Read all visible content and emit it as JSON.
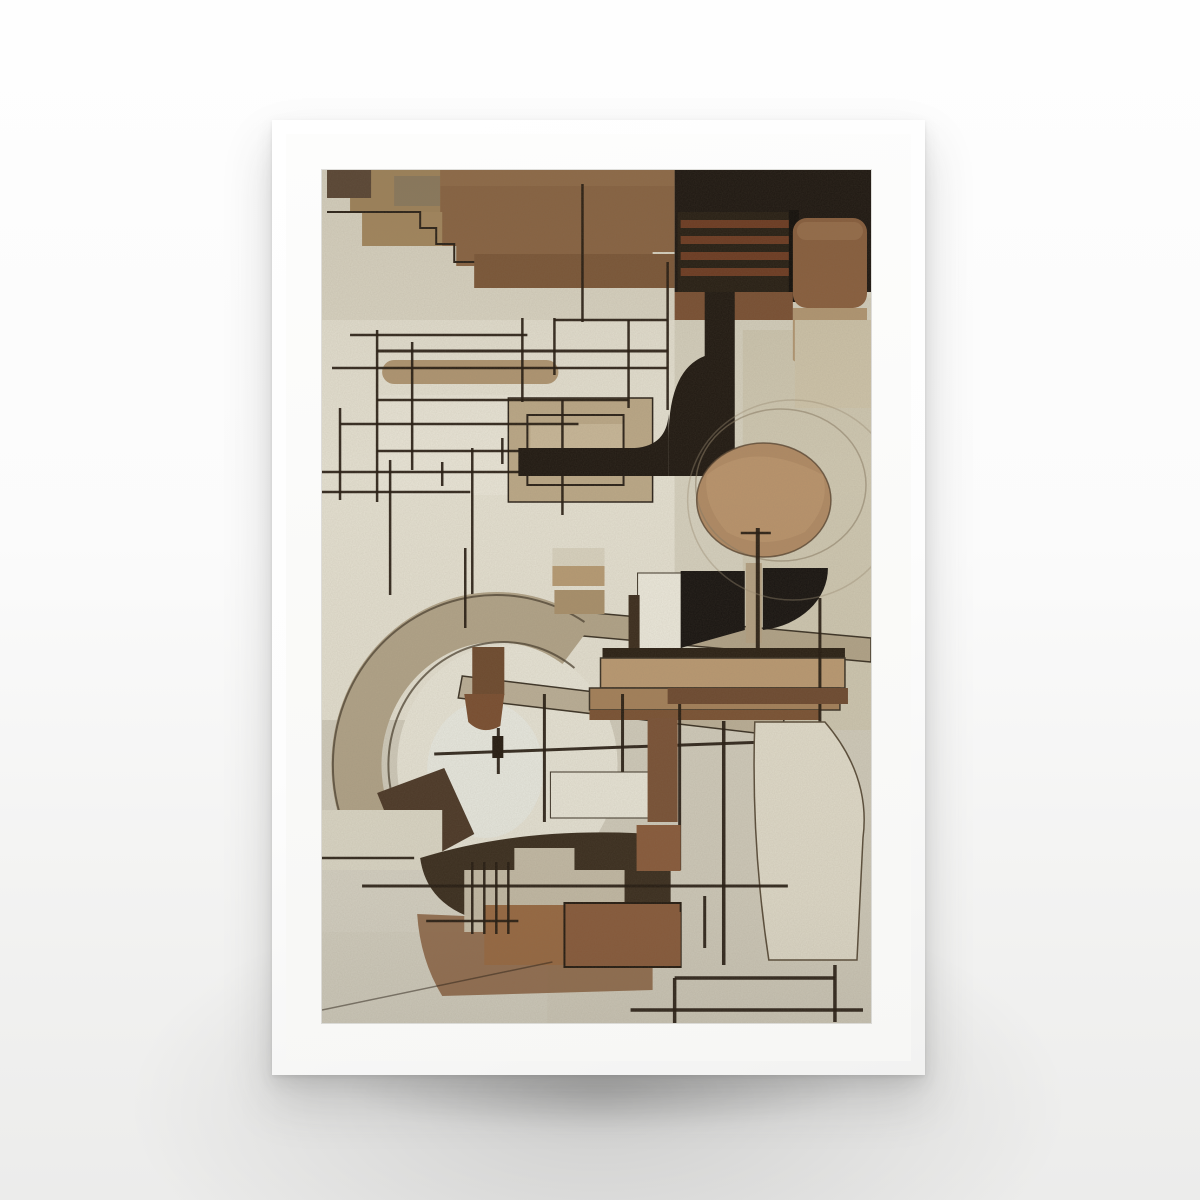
{
  "meta": {
    "description": "Product photo of a framed poster: abstract geometric constructivist composition in shades of brown, beige and black on textured paper, in a white frame with white mat, on a light studio background with soft shadow.",
    "artwork_alt": "Abstract cubist composition with brown rectangles, black fields, thin ruled black lines, arcs, a tan circle and curved black shapes on beige paper"
  },
  "palette": {
    "page_bg": "#fbfbfb",
    "frame": "#fdfdfd",
    "mat": "#fcfcfb",
    "paper": "#dbd6c5",
    "line_color": "#241a10",
    "brown_dark": "#5a4635",
    "brown_mid": "#8a6443",
    "tan": "#b09672",
    "black_field": "#1b1510"
  },
  "artwork": {
    "viewbox": "0 0 548 853",
    "shapes": [
      {
        "t": "rect",
        "x": 0,
        "y": 0,
        "w": 548,
        "h": 853,
        "f": "#dbd6c5"
      },
      {
        "t": "rect",
        "x": 0,
        "y": 150,
        "w": 352,
        "h": 400,
        "f": "#e5e1d2"
      },
      {
        "t": "rect",
        "x": 0,
        "y": 550,
        "w": 548,
        "h": 303,
        "f": "#d2cdbd"
      },
      {
        "t": "rect",
        "x": 352,
        "y": 128,
        "w": 196,
        "h": 430,
        "f": "#d6d1bf"
      },
      {
        "t": "rect",
        "x": 420,
        "y": 160,
        "w": 128,
        "h": 400,
        "f": "#cfc8b2"
      },
      {
        "t": "rect",
        "x": 28,
        "y": 0,
        "w": 92,
        "h": 42,
        "f": "#a1855c"
      },
      {
        "t": "rect",
        "x": 5,
        "y": 0,
        "w": 44,
        "h": 28,
        "f": "#5a4635"
      },
      {
        "t": "rect",
        "x": 72,
        "y": 6,
        "w": 46,
        "h": 30,
        "f": "#8d7b5f"
      },
      {
        "t": "poly",
        "pts": "118,0 352,0 352,82 330,82 330,118 152,118 152,96 134,96 134,76 118,76",
        "f": "#8a6443"
      },
      {
        "t": "rect",
        "x": 40,
        "y": 42,
        "w": 80,
        "h": 34,
        "f": "#a5885f"
      },
      {
        "t": "rect",
        "x": 152,
        "y": 84,
        "w": 200,
        "h": 34,
        "f": "#7c5738"
      },
      {
        "t": "rect",
        "x": 118,
        "y": 0,
        "w": 234,
        "h": 16,
        "f": "#97724e",
        "o": 0.55
      },
      {
        "t": "path",
        "d": "M5,42 L98,42 L98,58 L114,58 L114,74 L132,74 L132,92 L152,92",
        "s": "#2a2118",
        "sw": 2,
        "f": "none"
      },
      {
        "t": "line",
        "x1": 260,
        "y1": 14,
        "x2": 260,
        "y2": 152
      },
      {
        "t": "line",
        "x1": 345,
        "y1": 92,
        "x2": 345,
        "y2": 240
      },
      {
        "t": "rect",
        "x": 352,
        "y": 0,
        "w": 196,
        "h": 122,
        "f": "#1b1510"
      },
      {
        "t": "rect",
        "x": 355,
        "y": 42,
        "w": 118,
        "h": 88,
        "f": "#251d13"
      },
      {
        "t": "rect",
        "x": 358,
        "y": 50,
        "w": 110,
        "h": 8,
        "f": "#6e3b22"
      },
      {
        "t": "rect",
        "x": 358,
        "y": 66,
        "w": 110,
        "h": 8,
        "f": "#6e3b22"
      },
      {
        "t": "rect",
        "x": 358,
        "y": 82,
        "w": 110,
        "h": 8,
        "f": "#6e3b22"
      },
      {
        "t": "rect",
        "x": 358,
        "y": 98,
        "w": 110,
        "h": 8,
        "f": "#6e3b22"
      },
      {
        "t": "rect",
        "x": 466,
        "y": 40,
        "w": 10,
        "h": 92,
        "f": "#0f0c09"
      },
      {
        "t": "rect",
        "x": 470,
        "y": 48,
        "w": 74,
        "h": 90,
        "rx": 14,
        "f": "#8a5f3e"
      },
      {
        "t": "rect",
        "x": 474,
        "y": 52,
        "w": 66,
        "h": 18,
        "rx": 9,
        "f": "#9d7350",
        "o": 0.7
      },
      {
        "t": "path",
        "d": "M470,138 L544,138 L544,196 Q520,212 492,206 L470,190 Z",
        "f": "#b39873"
      },
      {
        "t": "rect",
        "x": 352,
        "y": 122,
        "w": 118,
        "h": 28,
        "f": "#7a5033"
      },
      {
        "t": "rect",
        "x": 472,
        "y": 150,
        "w": 76,
        "h": 88,
        "f": "#cfc5ab"
      },
      {
        "t": "rect",
        "x": 55,
        "y": 225,
        "w": 180,
        "h": 100,
        "f": "#e9e5d7"
      },
      {
        "t": "rect",
        "x": 186,
        "y": 228,
        "w": 144,
        "h": 104,
        "f": "#bba887",
        "s": "#2a2118",
        "sw": 1.5
      },
      {
        "t": "rect",
        "x": 208,
        "y": 254,
        "w": 92,
        "h": 46,
        "f": "#cdbd9f",
        "o": 0.7
      },
      {
        "t": "rect",
        "x": 60,
        "y": 190,
        "w": 176,
        "h": 24,
        "rx": 12,
        "f": "#b09672"
      },
      {
        "t": "line",
        "x1": 28,
        "y1": 165,
        "x2": 205,
        "y2": 165
      },
      {
        "t": "line",
        "x1": 55,
        "y1": 181,
        "x2": 345,
        "y2": 181,
        "sw": 3
      },
      {
        "t": "line",
        "x1": 10,
        "y1": 198,
        "x2": 345,
        "y2": 198
      },
      {
        "t": "line",
        "x1": 55,
        "y1": 230,
        "x2": 306,
        "y2": 230
      },
      {
        "t": "line",
        "x1": 18,
        "y1": 254,
        "x2": 256,
        "y2": 254
      },
      {
        "t": "line",
        "x1": 55,
        "y1": 281,
        "x2": 236,
        "y2": 281
      },
      {
        "t": "line",
        "x1": 0,
        "y1": 302,
        "x2": 205,
        "y2": 302
      },
      {
        "t": "line",
        "x1": 0,
        "y1": 322,
        "x2": 148,
        "y2": 322
      },
      {
        "t": "line",
        "x1": 55,
        "y1": 160,
        "x2": 55,
        "y2": 332
      },
      {
        "t": "line",
        "x1": 90,
        "y1": 172,
        "x2": 90,
        "y2": 300
      },
      {
        "t": "line",
        "x1": 200,
        "y1": 148,
        "x2": 200,
        "y2": 232
      },
      {
        "t": "line",
        "x1": 18,
        "y1": 238,
        "x2": 18,
        "y2": 330
      },
      {
        "t": "line",
        "x1": 68,
        "y1": 290,
        "x2": 68,
        "y2": 425
      },
      {
        "t": "line",
        "x1": 150,
        "y1": 278,
        "x2": 150,
        "y2": 430
      },
      {
        "t": "line",
        "x1": 232,
        "y1": 148,
        "x2": 232,
        "y2": 205
      },
      {
        "t": "line",
        "x1": 306,
        "y1": 150,
        "x2": 306,
        "y2": 238
      },
      {
        "t": "line",
        "x1": 232,
        "y1": 150,
        "x2": 345,
        "y2": 150
      },
      {
        "t": "rect",
        "x": 205,
        "y": 245,
        "w": 96,
        "h": 70,
        "f": "none",
        "s": "#2a2118",
        "sw": 2
      },
      {
        "t": "line",
        "x1": 240,
        "y1": 230,
        "x2": 240,
        "y2": 345
      },
      {
        "t": "line",
        "x1": 120,
        "y1": 292,
        "x2": 120,
        "y2": 316
      },
      {
        "t": "line",
        "x1": 180,
        "y1": 268,
        "x2": 180,
        "y2": 294
      },
      {
        "t": "rect",
        "x": 196,
        "y": 278,
        "w": 150,
        "h": 28,
        "f": "#1f1811"
      },
      {
        "t": "path",
        "d": "M412,122 L412,306 L346,306 L346,268 Q346,200 382,186 L382,122 Z",
        "f": "#1f1811"
      },
      {
        "t": "path",
        "d": "M312,278 Q344,276 346,244 L346,278 Z",
        "f": "#1f1811"
      },
      {
        "t": "ellipse",
        "cx": 441,
        "cy": 330,
        "ex": 67,
        "ey": 57,
        "f": "#b08a64"
      },
      {
        "t": "path",
        "d": "M384,305 Q430,268 500,305 Q508,335 482,362 Q440,382 404,362 Q380,335 384,305 Z",
        "f": "#c09a6f",
        "o": 0.6
      },
      {
        "t": "ellipse",
        "cx": 458,
        "cy": 315,
        "ex": 85,
        "ey": 76,
        "f": "none",
        "s": "#8a7c64",
        "sw": 1.5,
        "o": 0.55
      },
      {
        "t": "ellipse",
        "cx": 441,
        "cy": 330,
        "ex": 67,
        "ey": 57,
        "f": "none",
        "s": "#584430",
        "sw": 1.5,
        "o": 0.8
      },
      {
        "t": "poly",
        "pts": "150,432 548,468 548,492 150,456",
        "f": "#b2a489",
        "s": "#3a3124",
        "sw": 1.5
      },
      {
        "t": "ellipse",
        "cx": 185,
        "cy": 595,
        "ex": 110,
        "ey": 120,
        "f": "#e9e6d8"
      },
      {
        "t": "ellipse",
        "cx": 163,
        "cy": 600,
        "ex": 58,
        "ey": 68,
        "f": "#edf0ec",
        "o": 0.55
      },
      {
        "t": "path",
        "d": "M255,474 A140,148 0 1 0 255,716",
        "f": "none",
        "s": "#b2a489",
        "sw": 50
      },
      {
        "t": "path",
        "d": "M262,452 A163,170 0 1 0 262,738",
        "f": "none",
        "s": "#4a3f2f",
        "sw": 2,
        "o": 0.75
      },
      {
        "t": "path",
        "d": "M252,498 A115,123 0 1 0 252,692",
        "f": "none",
        "s": "#4a3f2f",
        "sw": 2,
        "o": 0.75
      },
      {
        "t": "poly",
        "pts": "140,506 462,545 458,566 136,528",
        "f": "#bcb098",
        "s": "#3a3124",
        "sw": 1.5
      },
      {
        "t": "rect",
        "x": 150,
        "y": 477,
        "w": 32,
        "h": 48,
        "f": "#6e4a2e"
      },
      {
        "t": "path",
        "d": "M142,524 L182,524 L178,556 Q160,566 146,552 Z",
        "f": "#7a4e30"
      },
      {
        "t": "poly",
        "pts": "55,623 122,598 152,664 86,700",
        "f": "#4c3827"
      },
      {
        "t": "line",
        "x1": 143,
        "y1": 378,
        "x2": 143,
        "y2": 458
      },
      {
        "t": "rect",
        "x": 230,
        "y": 378,
        "w": 52,
        "h": 18,
        "f": "#d9d3c0"
      },
      {
        "t": "rect",
        "x": 230,
        "y": 396,
        "w": 52,
        "h": 20,
        "f": "#b79b74"
      },
      {
        "t": "rect",
        "x": 232,
        "y": 420,
        "w": 50,
        "h": 24,
        "f": "#a9906b"
      },
      {
        "t": "rect",
        "x": 315,
        "y": 403,
        "w": 44,
        "h": 78,
        "f": "#edeadd",
        "s": "#3a3124",
        "sw": 1
      },
      {
        "t": "rect",
        "x": 306,
        "y": 425,
        "w": 11,
        "h": 53,
        "f": "#3b2c1d"
      },
      {
        "t": "poly",
        "pts": "358,401 422,401 422,460 358,478",
        "f": "#171310"
      },
      {
        "t": "rect",
        "x": 423,
        "y": 393,
        "w": 16,
        "h": 80,
        "f": "#b4a183"
      },
      {
        "t": "path",
        "d": "M440,398 L505,398 A75,62 0 0 1 440,460 Z",
        "f": "#171310"
      },
      {
        "t": "line",
        "x1": 435,
        "y1": 358,
        "x2": 435,
        "y2": 478,
        "sw": 4
      },
      {
        "t": "line",
        "x1": 418,
        "y1": 363,
        "x2": 448,
        "y2": 363
      },
      {
        "t": "rect",
        "x": 280,
        "y": 478,
        "w": 242,
        "h": 10,
        "f": "#2a2014"
      },
      {
        "t": "rect",
        "x": 278,
        "y": 488,
        "w": 244,
        "h": 30,
        "f": "#bb9a72",
        "s": "#3a3124",
        "sw": 1.5
      },
      {
        "t": "rect",
        "x": 267,
        "y": 518,
        "w": 250,
        "h": 22,
        "f": "#a5815a",
        "s": "#3a3124",
        "sw": 1.5
      },
      {
        "t": "rect",
        "x": 267,
        "y": 540,
        "w": 230,
        "h": 10,
        "f": "#7a5233"
      },
      {
        "t": "ellipse",
        "cx": 470,
        "cy": 330,
        "ex": 105,
        "ey": 100,
        "f": "none",
        "s": "#9a8d74",
        "sw": 1.5,
        "o": 0.4
      },
      {
        "t": "line",
        "x1": 497,
        "y1": 428,
        "x2": 497,
        "y2": 688,
        "sw": 3
      },
      {
        "t": "rect",
        "x": 0,
        "y": 700,
        "w": 162,
        "h": 62,
        "f": "#d8d4c6"
      },
      {
        "t": "rect",
        "x": 0,
        "y": 762,
        "w": 225,
        "h": 91,
        "f": "#d5d1c2"
      },
      {
        "t": "rect",
        "x": 0,
        "y": 640,
        "w": 120,
        "h": 60,
        "f": "#dedac9"
      },
      {
        "t": "path",
        "d": "M98,688 Q200,656 330,664 L348,664 L348,748 Q220,772 150,748 Q104,732 98,688 Z",
        "f": "#3a2d1e"
      },
      {
        "t": "path",
        "d": "M95,744 L330,754 L330,820 L120,826 Q98,790 95,744 Z",
        "f": "#8a5f3e",
        "o": 0.85
      },
      {
        "t": "poly",
        "pts": "142,700 192,700 192,678 252,678 252,700 302,700 302,762 142,762",
        "f": "#cdc5b0",
        "o": 0.95
      },
      {
        "t": "rect",
        "x": 162,
        "y": 735,
        "w": 86,
        "h": 60,
        "f": "#9a6a42"
      },
      {
        "t": "rect",
        "x": 242,
        "y": 733,
        "w": 116,
        "h": 64,
        "f": "#8a5b3b",
        "s": "#241a10",
        "sw": 2
      },
      {
        "t": "line",
        "x1": 112,
        "y1": 584,
        "x2": 442,
        "y2": 572,
        "sw": 3
      },
      {
        "t": "line",
        "x1": 222,
        "y1": 524,
        "x2": 222,
        "y2": 652,
        "sw": 3
      },
      {
        "t": "line",
        "x1": 300,
        "y1": 524,
        "x2": 300,
        "y2": 640,
        "sw": 3
      },
      {
        "t": "line",
        "x1": 176,
        "y1": 558,
        "x2": 176,
        "y2": 604,
        "sw": 3
      },
      {
        "t": "rect",
        "x": 170,
        "y": 566,
        "w": 11,
        "h": 22,
        "f": "#241a10"
      },
      {
        "t": "rect",
        "x": 228,
        "y": 602,
        "w": 112,
        "h": 46,
        "f": "#ebe8da",
        "s": "#3a3124",
        "sw": 1
      },
      {
        "t": "rect",
        "x": 325,
        "y": 548,
        "w": 30,
        "h": 104,
        "f": "#7a5236"
      },
      {
        "t": "line",
        "x1": 357,
        "y1": 518,
        "x2": 357,
        "y2": 700,
        "sw": 3
      },
      {
        "t": "rect",
        "x": 345,
        "y": 518,
        "w": 180,
        "h": 16,
        "f": "#6e4a30"
      },
      {
        "t": "path",
        "d": "M432,552 L502,552 Q548,606 540,668 L534,790 L446,790 Q428,672 432,552 Z",
        "f": "#e3decd",
        "s": "#5a4d3a",
        "sw": 1.5
      },
      {
        "t": "line",
        "x1": 401,
        "y1": 551,
        "x2": 401,
        "y2": 795,
        "sw": 3.5
      },
      {
        "t": "line",
        "x1": 382,
        "y1": 726,
        "x2": 382,
        "y2": 778,
        "sw": 3
      },
      {
        "t": "rect",
        "x": 314,
        "y": 655,
        "w": 44,
        "h": 46,
        "f": "#8a5b3b"
      },
      {
        "t": "rect",
        "x": 312,
        "y": 742,
        "w": 46,
        "h": 54,
        "f": "#8a5b3b"
      },
      {
        "t": "line",
        "x1": 40,
        "y1": 716,
        "x2": 465,
        "y2": 716,
        "sw": 3
      },
      {
        "t": "line",
        "x1": 150,
        "y1": 692,
        "x2": 150,
        "y2": 764
      },
      {
        "t": "line",
        "x1": 162,
        "y1": 692,
        "x2": 162,
        "y2": 764
      },
      {
        "t": "line",
        "x1": 174,
        "y1": 692,
        "x2": 174,
        "y2": 764
      },
      {
        "t": "line",
        "x1": 186,
        "y1": 692,
        "x2": 186,
        "y2": 764
      },
      {
        "t": "line",
        "x1": 104,
        "y1": 751,
        "x2": 196,
        "y2": 751
      },
      {
        "t": "line",
        "x1": 0,
        "y1": 688,
        "x2": 92,
        "y2": 688
      },
      {
        "t": "line",
        "x1": 0,
        "y1": 840,
        "x2": 230,
        "y2": 792,
        "sw": 1.5,
        "o": 0.5
      },
      {
        "t": "line",
        "x1": 352,
        "y1": 808,
        "x2": 512,
        "y2": 808,
        "sw": 3.5
      },
      {
        "t": "line",
        "x1": 512,
        "y1": 795,
        "x2": 512,
        "y2": 852,
        "sw": 3.5
      },
      {
        "t": "line",
        "x1": 308,
        "y1": 840,
        "x2": 540,
        "y2": 840,
        "sw": 3.5
      },
      {
        "t": "line",
        "x1": 352,
        "y1": 808,
        "x2": 352,
        "y2": 853,
        "sw": 3.5
      },
      {
        "t": "rect",
        "x": 0,
        "y": 0,
        "w": 548,
        "h": 853,
        "filter": "url(#grain)",
        "o": 0.35
      },
      {
        "t": "rect",
        "x": 0,
        "y": 0,
        "w": 548,
        "h": 853,
        "f": "url(#shade)"
      }
    ]
  }
}
